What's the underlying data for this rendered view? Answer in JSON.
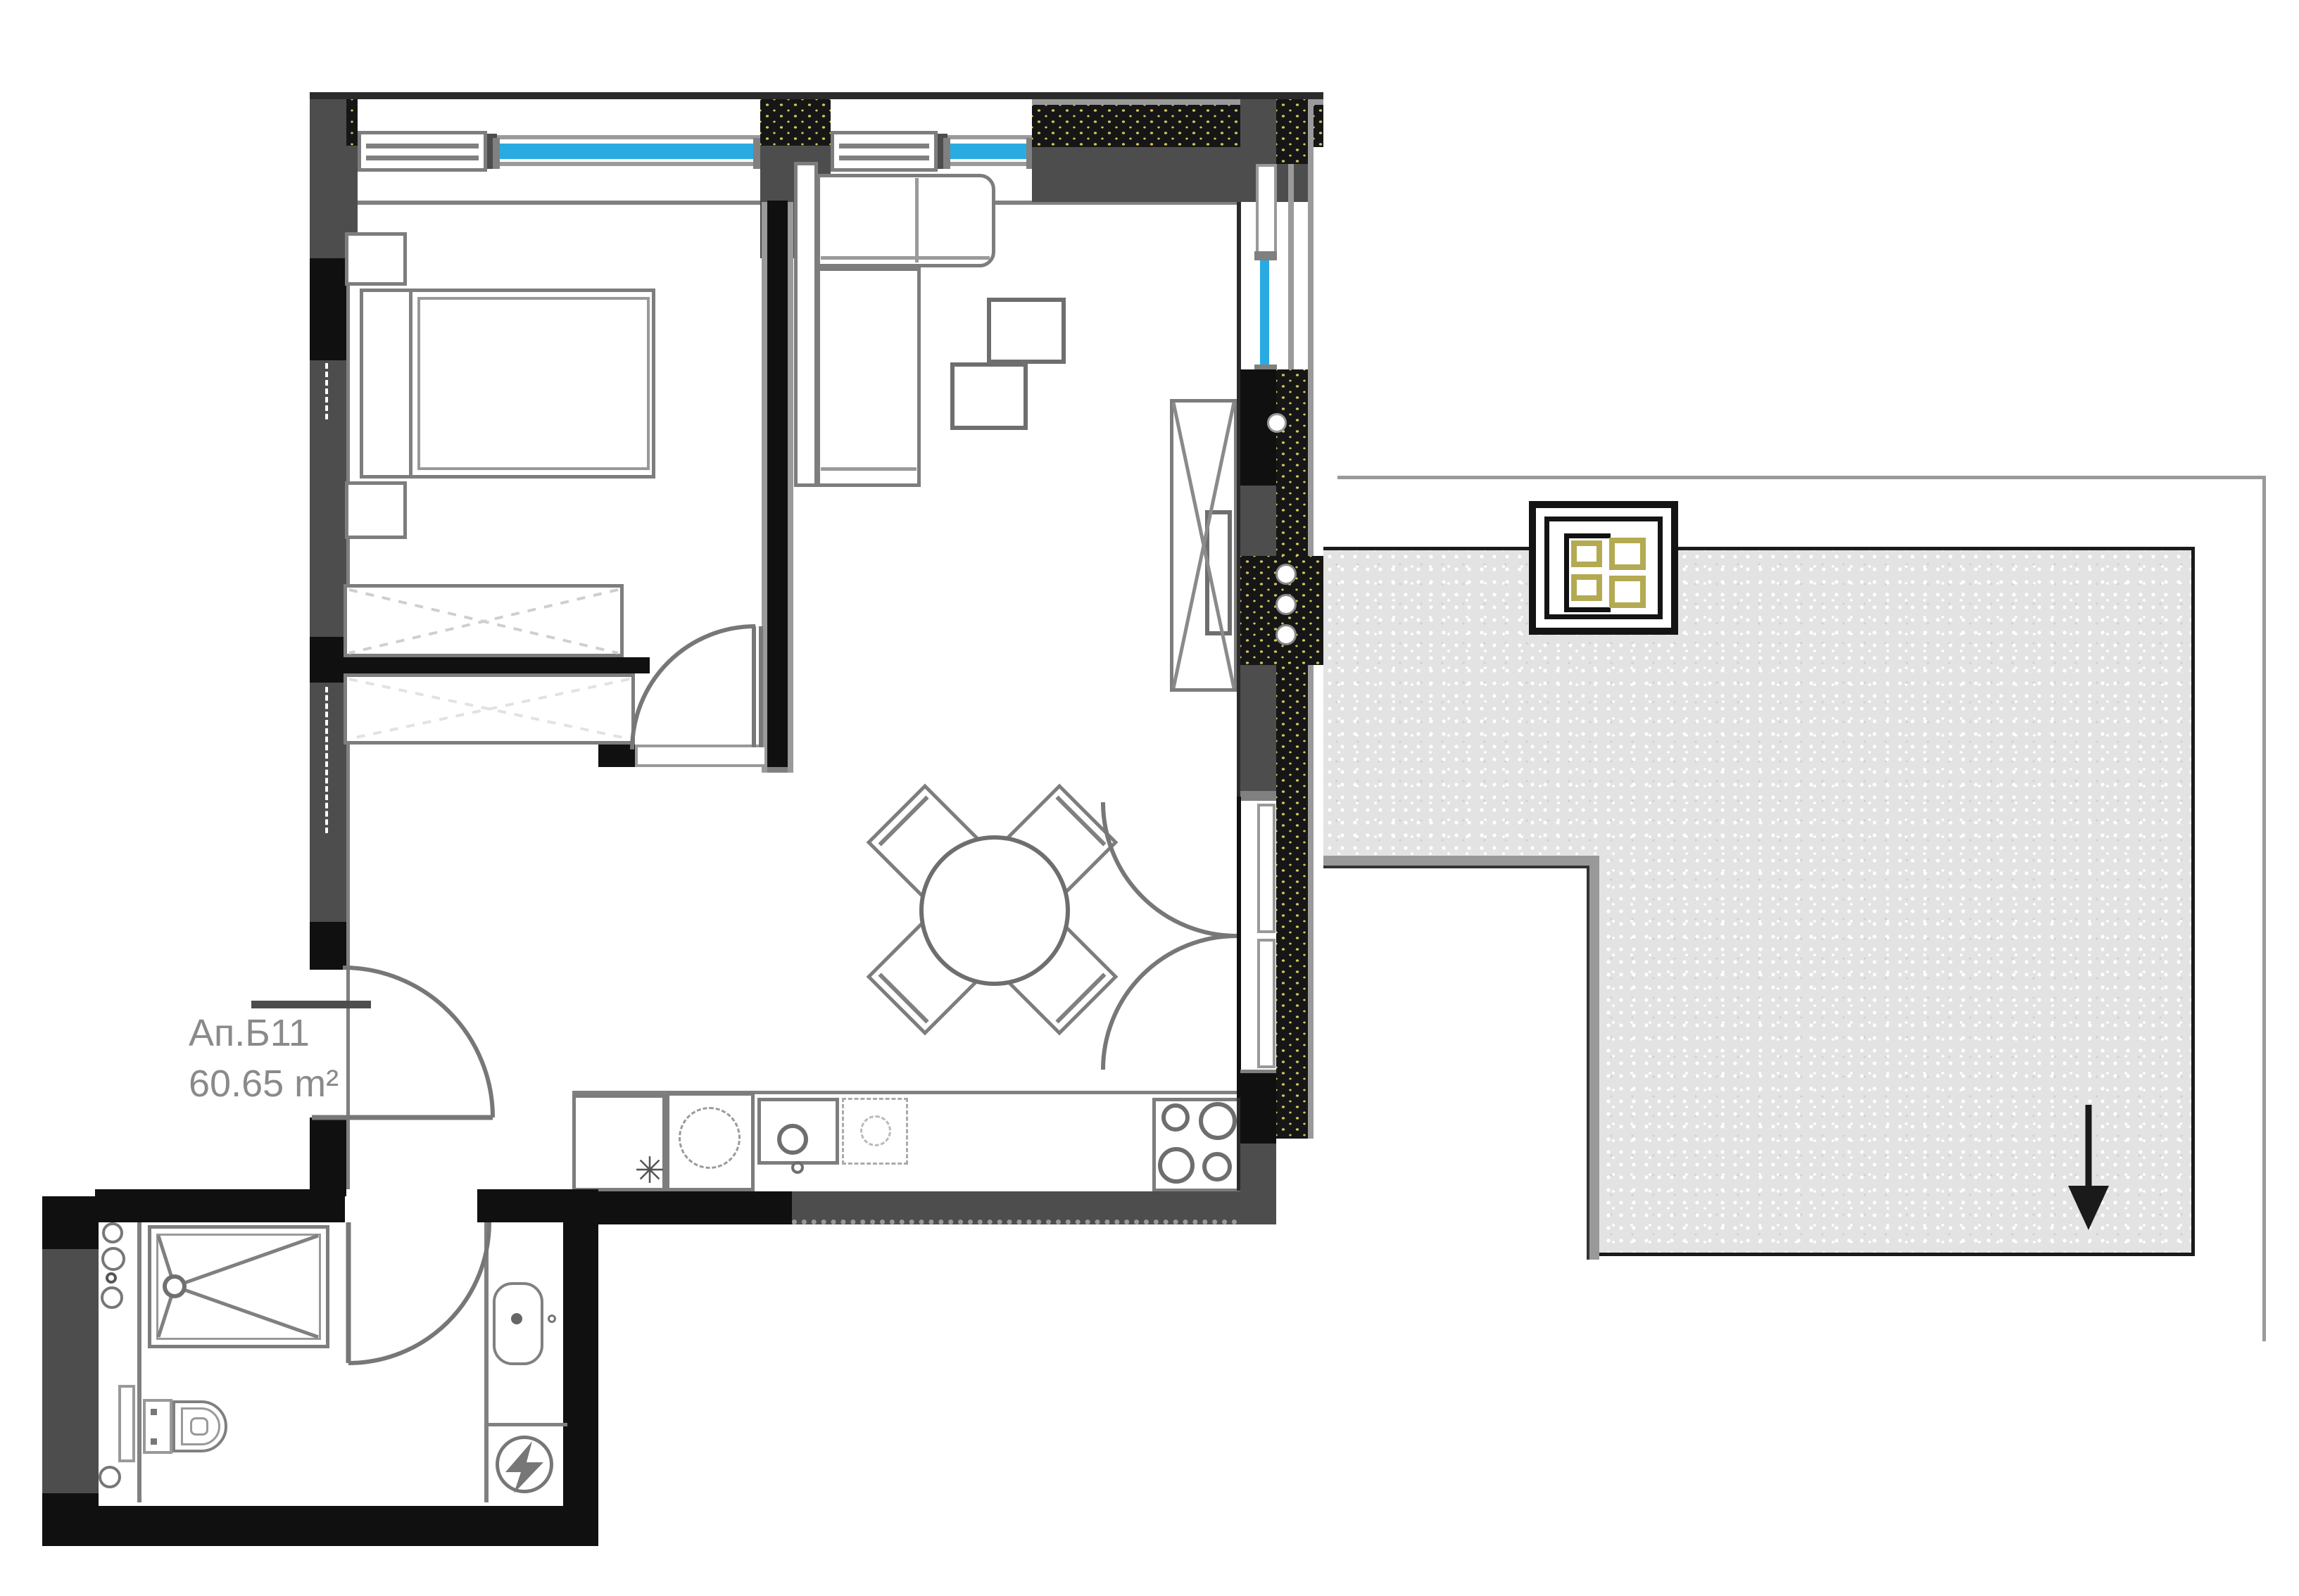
{
  "labels": {
    "apartment_id": "Ап.Б11",
    "area": "60.65 m²"
  },
  "glyphs": {
    "snowflake": "✳"
  },
  "colors": {
    "wall_dark": "#4d4d4d",
    "wall_black": "#101010",
    "outline_gray": "#808080",
    "glazing_blue": "#29abe2",
    "insulation_dot": "#cfc45e",
    "terrace_fill": "#e3e3e3",
    "skylight_olive": "#b3aa52",
    "text_gray": "#8a8a8a"
  },
  "symbols": [
    "bed",
    "nightstand",
    "wardrobe",
    "sofa",
    "coffee-table",
    "tv-cabinet",
    "dining-table",
    "dining-chair",
    "fridge-snowflake",
    "kitchen-sink",
    "hob",
    "shower-tray",
    "toilet",
    "washbasin",
    "electrical-panel",
    "pipe-riser",
    "window-glazing",
    "door-swing",
    "skylight",
    "chimney-flues",
    "drain-arrow"
  ]
}
